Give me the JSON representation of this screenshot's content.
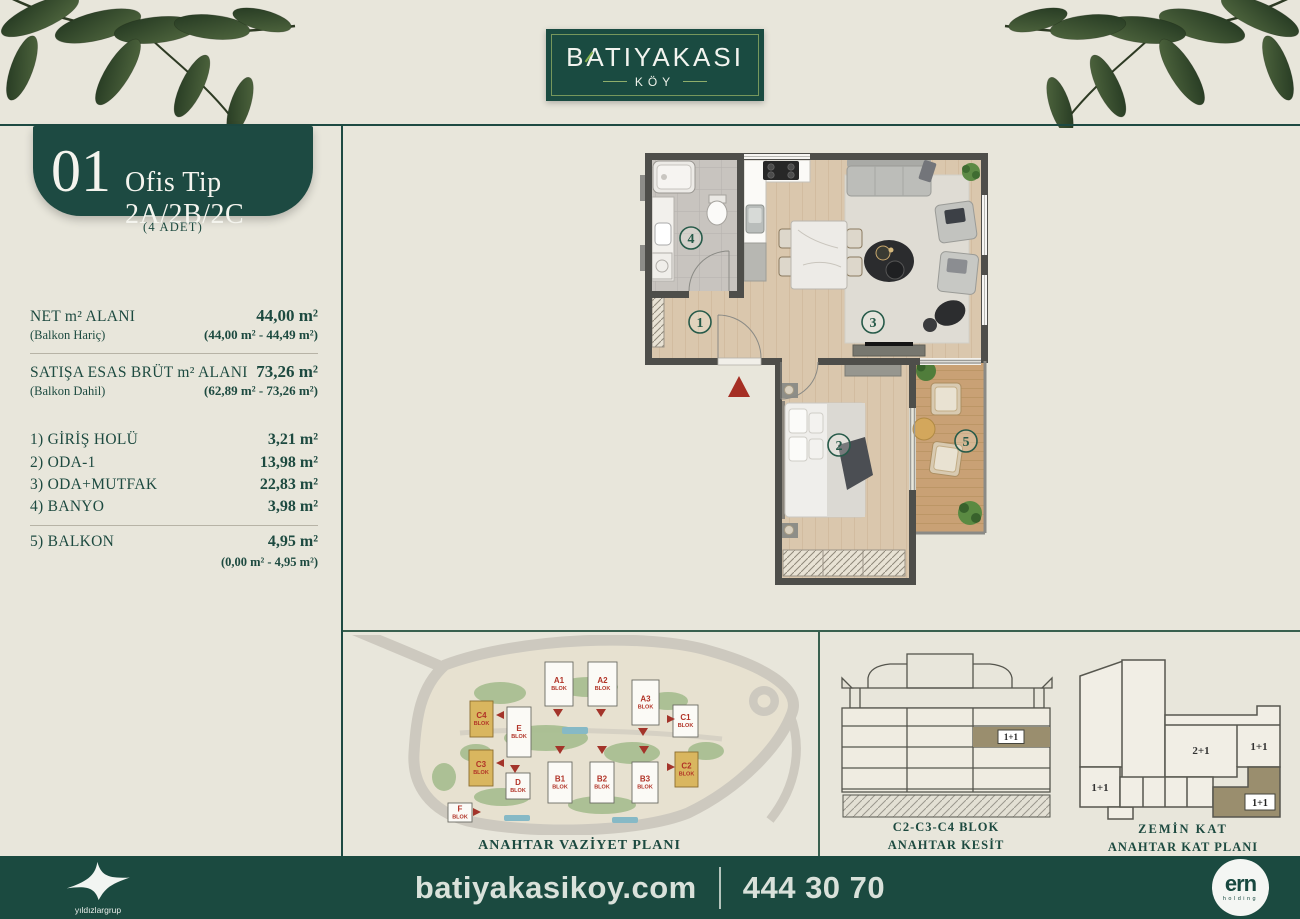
{
  "page": {
    "background": "#e8e6db",
    "accent_green": "#1d4a40",
    "footer_bg": "#1b4a40",
    "highlight_gold": "#d9b65f",
    "highlight_olive": "#9a8e6e",
    "marker_red": "#a52f24"
  },
  "header": {
    "logo_title": "BATIYAKASI",
    "logo_subtitle": "KÖY"
  },
  "unit_panel": {
    "number": "01",
    "type_label": "Ofis Tip 2A/2B/2C",
    "count_note": "(4 ADET)",
    "area_groups": [
      {
        "label": "NET m² ALANI",
        "value": "44,00 m²",
        "sub_label": "(Balkon Hariç)",
        "sub_value": "(44,00 m² - 44,49 m²)"
      },
      {
        "label": "SATIŞA ESAS BRÜT m² ALANI",
        "value": "73,26 m²",
        "sub_label": "(Balkon Dahil)",
        "sub_value": "(62,89 m² - 73,26 m²)"
      }
    ],
    "rooms": [
      {
        "name": "1) GİRİŞ HOLÜ",
        "area": "3,21 m²"
      },
      {
        "name": "2) ODA-1",
        "area": "13,98 m²"
      },
      {
        "name": "3) ODA+MUTFAK",
        "area": "22,83 m²"
      },
      {
        "name": "4) BANYO",
        "area": "3,98 m²"
      },
      {
        "name": "5) BALKON",
        "area": "4,95 m²"
      }
    ],
    "balkon_range": "(0,00 m² - 4,95 m²)"
  },
  "floor_plan": {
    "markers": [
      {
        "num": "1"
      },
      {
        "num": "2"
      },
      {
        "num": "3"
      },
      {
        "num": "4"
      },
      {
        "num": "5"
      }
    ]
  },
  "site_plan": {
    "caption": "ANAHTAR VAZİYET PLANI",
    "blocks": [
      {
        "id": "A1",
        "sub": "BLOK",
        "x": 195,
        "y": 27,
        "w": 28,
        "h": 44,
        "highlighted": false
      },
      {
        "id": "A2",
        "sub": "BLOK",
        "x": 238,
        "y": 27,
        "w": 29,
        "h": 44,
        "highlighted": false
      },
      {
        "id": "A3",
        "sub": "BLOK",
        "x": 282,
        "y": 45,
        "w": 27,
        "h": 45,
        "highlighted": false
      },
      {
        "id": "C1",
        "sub": "BLOK",
        "x": 323,
        "y": 70,
        "w": 25,
        "h": 32,
        "highlighted": false
      },
      {
        "id": "C4",
        "sub": "BLOK",
        "x": 120,
        "y": 66,
        "w": 23,
        "h": 36,
        "highlighted": true
      },
      {
        "id": "E",
        "sub": "BLOK",
        "x": 157,
        "y": 72,
        "w": 24,
        "h": 50,
        "highlighted": false
      },
      {
        "id": "C3",
        "sub": "BLOK",
        "x": 119,
        "y": 115,
        "w": 24,
        "h": 36,
        "highlighted": true
      },
      {
        "id": "D",
        "sub": "BLOK",
        "x": 156,
        "y": 138,
        "w": 24,
        "h": 26,
        "highlighted": false
      },
      {
        "id": "B1",
        "sub": "BLOK",
        "x": 198,
        "y": 127,
        "w": 24,
        "h": 41,
        "highlighted": false
      },
      {
        "id": "B2",
        "sub": "BLOK",
        "x": 240,
        "y": 127,
        "w": 24,
        "h": 41,
        "highlighted": false
      },
      {
        "id": "B3",
        "sub": "BLOK",
        "x": 282,
        "y": 127,
        "w": 26,
        "h": 41,
        "highlighted": false
      },
      {
        "id": "C2",
        "sub": "BLOK",
        "x": 325,
        "y": 117,
        "w": 23,
        "h": 35,
        "highlighted": true
      },
      {
        "id": "F",
        "sub": "BLOK",
        "x": 98,
        "y": 168,
        "w": 24,
        "h": 19,
        "highlighted": false
      }
    ]
  },
  "section_panel": {
    "caption_line1": "C2-C3-C4 BLOK",
    "caption_line2": "ANAHTAR KESİT",
    "unit_label": "1+1"
  },
  "key_plan": {
    "caption_line1": "ZEMİN  KAT",
    "caption_line2": "ANAHTAR KAT PLANI",
    "units": [
      {
        "label": "2+1"
      },
      {
        "label": "1+1"
      },
      {
        "label": "1+1"
      },
      {
        "label": "1+1"
      }
    ]
  },
  "footer": {
    "website": "batiyakasikoy.com",
    "phone": "444 30 70",
    "group_logo_label": "yıldızlargrup",
    "holding_logo_label": "ern",
    "holding_logo_sub": "holding"
  }
}
